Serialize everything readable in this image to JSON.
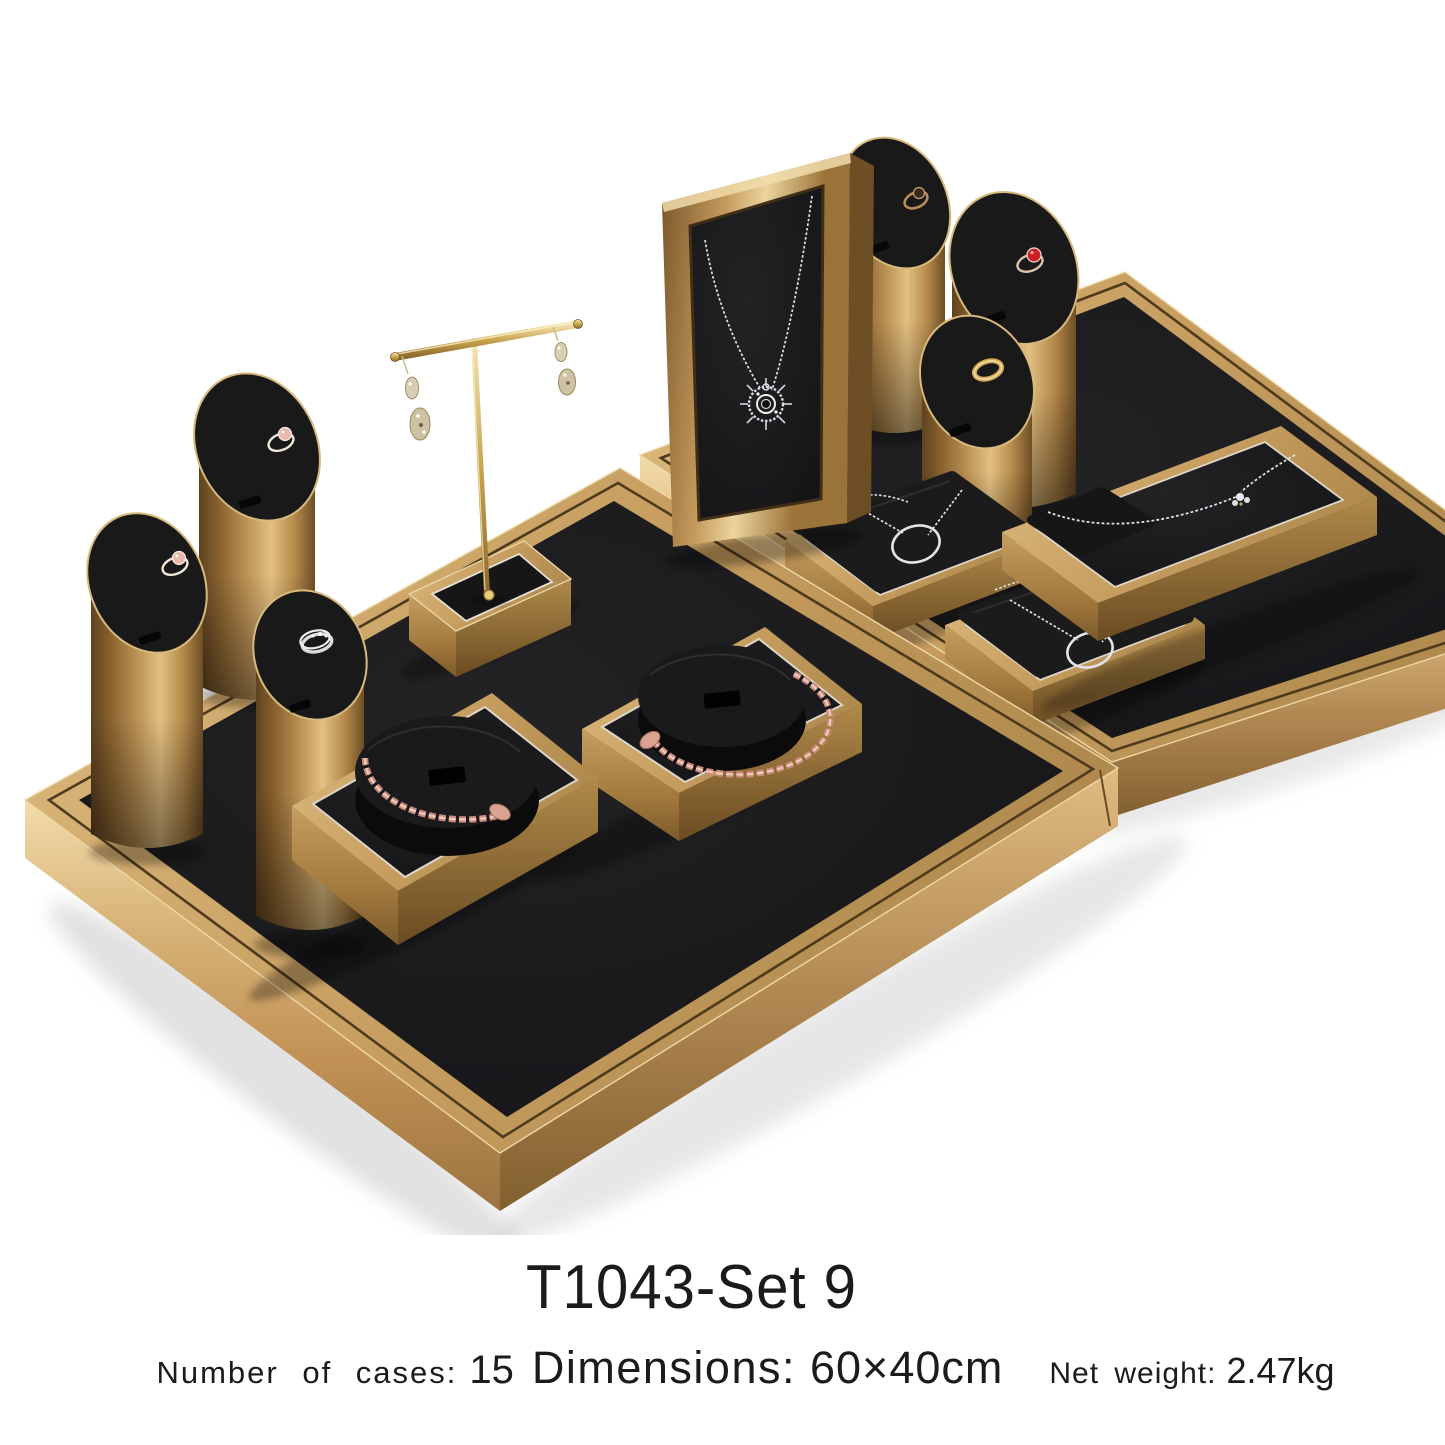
{
  "caption": {
    "title": "T1043-Set 9",
    "specs": [
      {
        "label": "Number of cases:",
        "value": "15"
      },
      {
        "label": "Dimensions:",
        "value": "60×40cm"
      },
      {
        "label": "Net weight:",
        "value": "2.47kg"
      }
    ]
  },
  "palette": {
    "background": "#ffffff",
    "gold_light": "#ecd49e",
    "gold": "#c49d62",
    "gold_dark": "#8a6536",
    "velvet_black": "#181818",
    "rose_gold": "#d9a392",
    "silver": "#e0e1e6",
    "ruby_red": "#cc2025",
    "pink_stone": "#e8b9ac",
    "piping_white": "#ddd6c8",
    "shadow_gray": "#cccccc",
    "text_color": "#1b1b1b"
  },
  "scene": {
    "items": [
      "left-display-tray",
      "right-display-tray",
      "ring-stand-cylinders-left",
      "ring-stand-cylinders-right",
      "t-bar-earring-stand",
      "framed-necklace-display",
      "pendant-pillow-trays",
      "necklace-tray",
      "snake-bracelet-trays"
    ]
  }
}
